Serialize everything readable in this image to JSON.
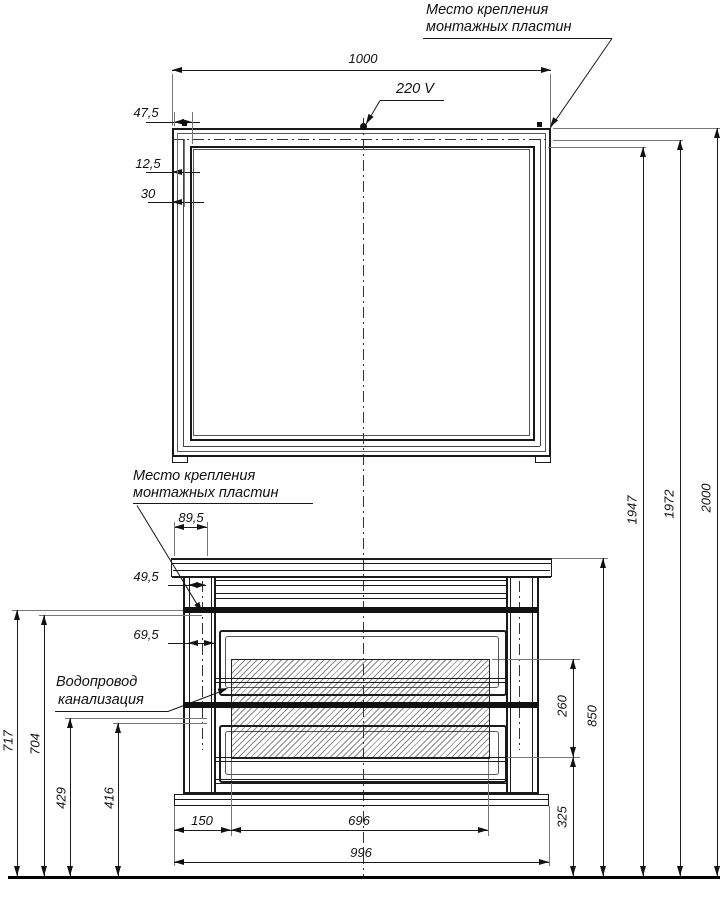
{
  "drawing_labels": {
    "mounting_top_1": "Место крепления",
    "mounting_top_2": "монтажных пластин",
    "mounting_mid_1": "Место крепления",
    "mounting_mid_2": "монтажных пластин",
    "plumbing_1": "Водопровод",
    "plumbing_2": "канализация",
    "voltage": "220 V"
  },
  "dimensions": {
    "mirror_width": "1000",
    "frame_offset_47": "47,5",
    "frame_offset_12": "12,5",
    "frame_offset_30": "30",
    "plate_offset_89": "89,5",
    "plate_offset_49": "49,5",
    "plate_offset_69": "69,5",
    "pipe_level_717": "717",
    "pipe_level_704": "704",
    "pipe_level_429": "429",
    "pipe_level_416": "416",
    "cutout_left_150": "150",
    "cutout_width_696": "696",
    "cabinet_width_996": "996",
    "cutout_height_260": "260",
    "cabinet_top_height_850": "850",
    "cutout_floor_height_325": "325",
    "glass_top_height_1947": "1947",
    "plate_height_1972": "1972",
    "total_height_2000": "2000"
  }
}
